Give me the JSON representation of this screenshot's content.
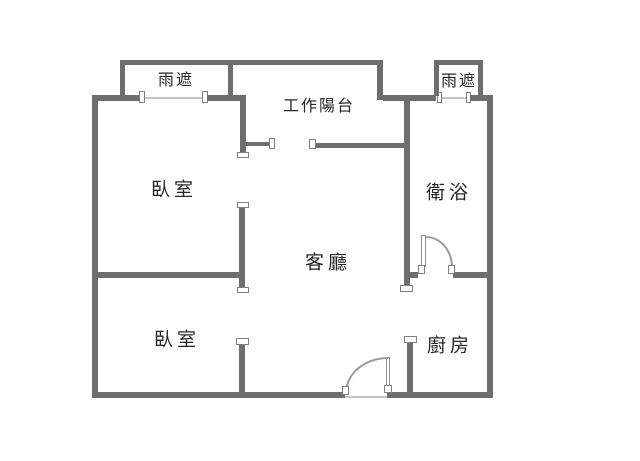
{
  "plan": {
    "labels": {
      "canopy_left": "雨遮",
      "canopy_right": "雨遮",
      "work_balcony": "工作陽台",
      "bedroom_top": "臥室",
      "bathroom": "衛浴",
      "living_room": "客廳",
      "bedroom_bottom": "臥室",
      "kitchen": "廚房"
    },
    "colors": {
      "wall": "#6e6e6e",
      "window_line": "#c3c3c3",
      "door_arc": "#9b9b9b",
      "marker_fill": "#ffffff",
      "marker_border": "#7f7f7f",
      "text": "#262626",
      "background": "#ffffff"
    }
  }
}
